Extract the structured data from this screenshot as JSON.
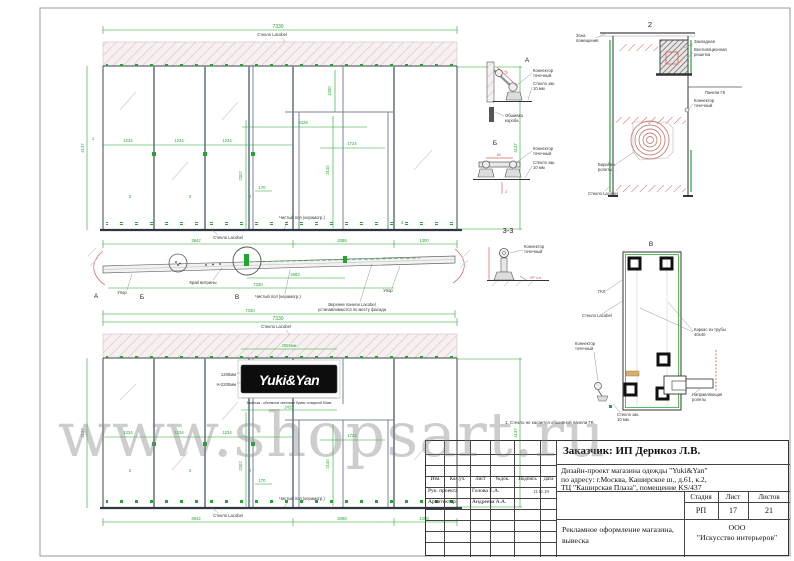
{
  "watermark": "www.shopsart.ru",
  "colors": {
    "dim_green": "#23a52e",
    "detail_red": "#d4645a",
    "structure": "#7a8699",
    "sign_bg": "#0d0d0d",
    "sign_text": "#ffffff"
  },
  "elev": {
    "dim_width": "7330",
    "glass": "Стекло Lacobel",
    "floor": "Чистый пол (керамогр.)",
    "p1": "1234",
    "p2": "1234",
    "p3": "1234",
    "d2429": "2429",
    "d1724": "1724",
    "d1000": "1000",
    "d2302": "2302",
    "d2140": "2140",
    "d170": "170",
    "h": "4137",
    "b1": "3942",
    "b2": "2088",
    "b3": "1300"
  },
  "marks": {
    "one": "1",
    "two": "2",
    "three": "3"
  },
  "sign": {
    "text": "Yuki&Yan",
    "h1": "1200мм",
    "h2": "Н-2200мм",
    "w": "2055мм",
    "note": "Вывеска - объемные световые буквы толщиной 50мм",
    "d": "2429"
  },
  "plan": {
    "a": "А",
    "b": "Б",
    "v": "В",
    "upor": "Упор",
    "edge": "Край витрины",
    "floor": "Чистый пол (керамогр.)",
    "note1": "Верхние панели Lacobel",
    "note2": "устанавливаются по месту фасада",
    "d2083": "2083",
    "d7330": "7330"
  },
  "lbl": {
    "conn1": "Коннектор",
    "conn2": "точечный",
    "glass1": "Стекло зак.",
    "glass2": "10 мм"
  },
  "det_a": {
    "t": "А",
    "dim": "73",
    "cover1": "Обшивка",
    "cover2": "короба"
  },
  "det_b": {
    "t": "Б",
    "dim": "82",
    "d2": "2"
  },
  "d2": {
    "t": "2",
    "zone1": "Зона",
    "zone2": "помещения",
    "zakl": "Закладная",
    "vent1": "Вентиляционная",
    "vent2": "решетка",
    "gk": "Панели ГК",
    "drum1": "Барабан",
    "drum2": "ролеты",
    "glass": "Стекло Lacobel"
  },
  "d33": {
    "t": "3-3",
    "floor": "УР ч.п."
  },
  "dv": {
    "t": "В",
    "gkl": "ГКЛ",
    "glass": "Стекло Lacobel",
    "frame1": "Каркас из трубы",
    "frame2": "40х40",
    "guide1": "Направляющая",
    "guide2": "ролеты",
    "note": "1. Стекло не касается обшивной панели ГК."
  },
  "title_block": {
    "customer": "Заказчик: ИП Дерикоз Л.В.",
    "project_line1": "Дизайн-проект магазина одежды \"Yuki&Yan\"",
    "project_line2": "по адресу: г.Москва, Каширское ш., д.61, к.2,",
    "project_line3": "ТЦ \"Каширская Плаза\", помещение KS/437",
    "col1": "Изм.",
    "col2": "Кол.уч.",
    "col3": "Лист",
    "col4": "№док.",
    "col5": "Подпись",
    "col6": "Дата",
    "row1_role": "Рук. проекта",
    "row1_name": "Голова Е.А.",
    "row1_date": "11.11.19",
    "row2_role": "Архитектор",
    "row2_name": "Андреева А.А.",
    "stage_header": "Стадия",
    "sheet_header": "Лист",
    "sheets_header": "Листов",
    "stage": "РП",
    "sheet": "17",
    "sheets": "21",
    "subject_line1": "Рекламное оформление магазина,",
    "subject_line2": "вывеска",
    "company_line1": "ООО",
    "company_line2": "\"Искусство интерьеров\""
  }
}
